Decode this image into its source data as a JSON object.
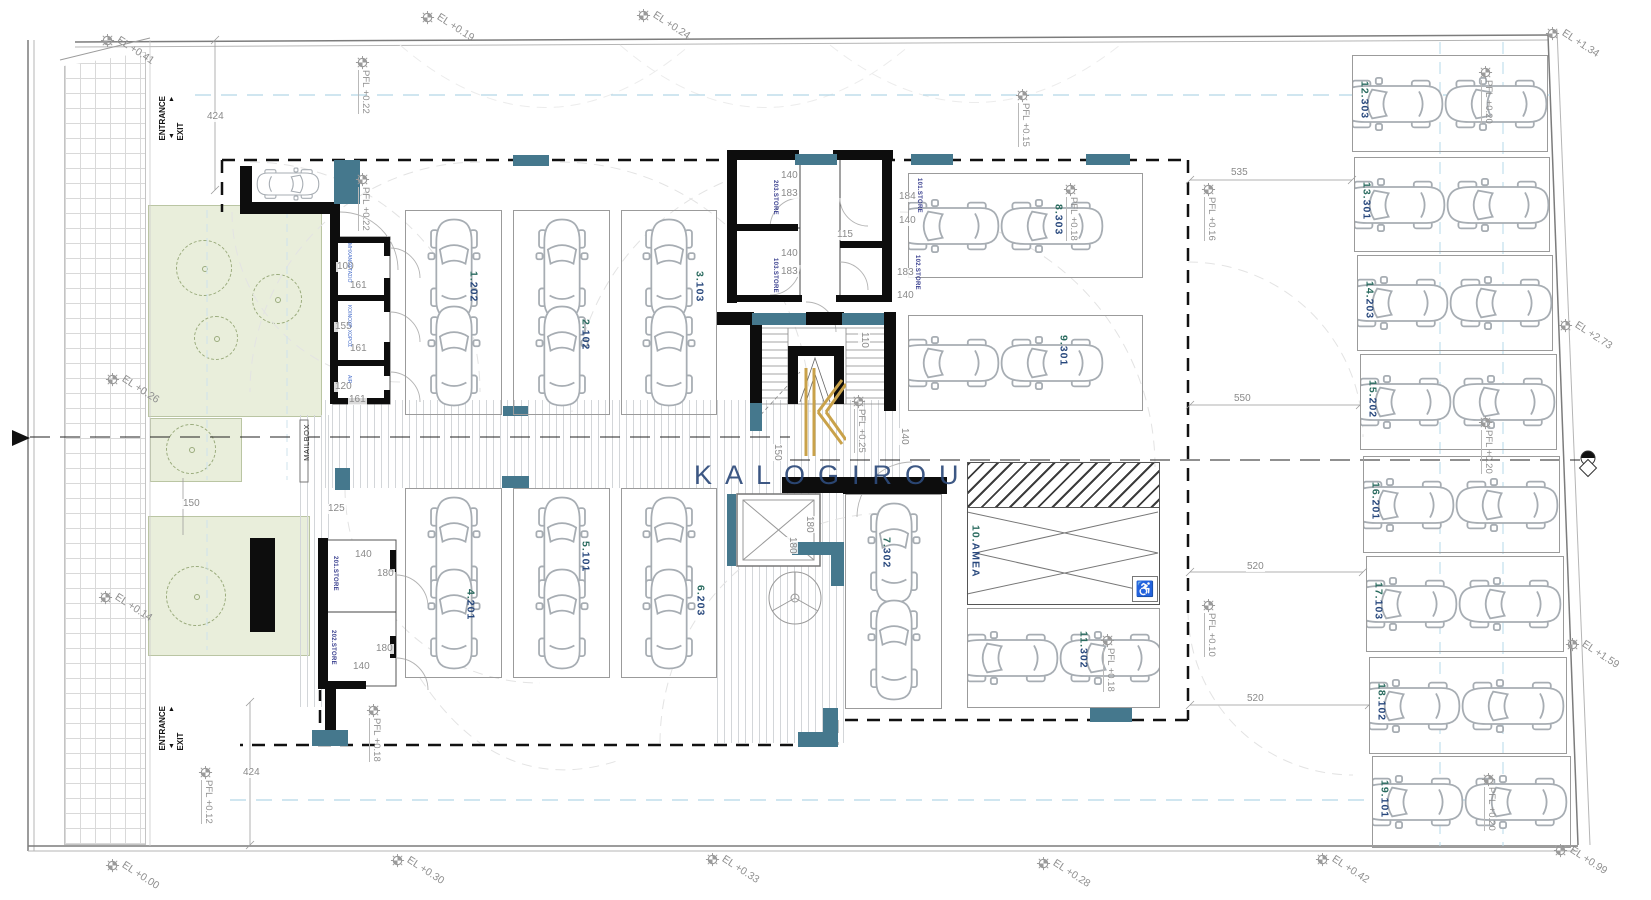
{
  "title": "Parking level floor plan",
  "brand": {
    "logo_text": "KALOGIROU"
  },
  "colors": {
    "teal": "#45788d",
    "wall": "#0d0d0d",
    "parking_num": "#2a6b5f",
    "parking_code": "#27477c",
    "store_text": "#383e8e",
    "room_text": "#4c72cc",
    "dim_text": "#8a8a8a",
    "marker_text": "#8f8f8f",
    "logo_gold": "#c9a24a",
    "logo_navy": "#2d4a7a",
    "green": "#e9eedb",
    "blue_dash": "#b5d8e8"
  },
  "texts": {
    "entrance": "ENTRANCE",
    "exit": "EXIT",
    "arrow_up": "▲",
    "arrow_down": "▼",
    "mailbox": "MAILBOX",
    "wheelchair_icon": "♿"
  },
  "elevation_markers": [
    {
      "label": "EL +0.41",
      "x": 100,
      "y": 33
    },
    {
      "label": "EL +0.19",
      "x": 420,
      "y": 10
    },
    {
      "label": "EL +0.24",
      "x": 636,
      "y": 8
    },
    {
      "label": "EL +1.34",
      "x": 1545,
      "y": 26
    },
    {
      "label": "EL +2.73",
      "x": 1558,
      "y": 318
    },
    {
      "label": "EL +1.59",
      "x": 1565,
      "y": 637
    },
    {
      "label": "EL +0.99",
      "x": 1553,
      "y": 843
    },
    {
      "label": "EL +0.42",
      "x": 1315,
      "y": 852
    },
    {
      "label": "EL +0.28",
      "x": 1036,
      "y": 856
    },
    {
      "label": "EL +0.33",
      "x": 705,
      "y": 852
    },
    {
      "label": "EL +0.30",
      "x": 390,
      "y": 853
    },
    {
      "label": "EL +0.00",
      "x": 105,
      "y": 858
    },
    {
      "label": "EL +0.26",
      "x": 105,
      "y": 372
    },
    {
      "label": "EL +0.14",
      "x": 98,
      "y": 590
    }
  ],
  "pfl_markers": [
    {
      "label": "PFL +0.22",
      "x": 355,
      "y": 55
    },
    {
      "label": "PFL +0.22",
      "x": 355,
      "y": 172
    },
    {
      "label": "PFL +0.15",
      "x": 1015,
      "y": 88
    },
    {
      "label": "PFL +0.18",
      "x": 1063,
      "y": 182
    },
    {
      "label": "PFL +0.16",
      "x": 1201,
      "y": 182
    },
    {
      "label": "PFL +0.25",
      "x": 851,
      "y": 394
    },
    {
      "label": "PFL +0.20",
      "x": 1478,
      "y": 65
    },
    {
      "label": "PFL +0.20",
      "x": 1478,
      "y": 415
    },
    {
      "label": "PFL +0.20",
      "x": 1481,
      "y": 772
    },
    {
      "label": "PFL +0.10",
      "x": 1201,
      "y": 598
    },
    {
      "label": "PFL +0.18",
      "x": 1100,
      "y": 633
    },
    {
      "label": "PFL +0.12",
      "x": 198,
      "y": 765
    },
    {
      "label": "PFL +0.18",
      "x": 366,
      "y": 703
    }
  ],
  "dimensions": [
    {
      "text": "424",
      "x": 206,
      "y": 112
    },
    {
      "text": "424",
      "x": 242,
      "y": 768
    },
    {
      "text": "535",
      "x": 1230,
      "y": 168
    },
    {
      "text": "550",
      "x": 1233,
      "y": 394
    },
    {
      "text": "520",
      "x": 1246,
      "y": 562
    },
    {
      "text": "520",
      "x": 1246,
      "y": 694
    },
    {
      "text": "115",
      "x": 836,
      "y": 230
    },
    {
      "text": "140",
      "x": 780,
      "y": 171
    },
    {
      "text": "183",
      "x": 780,
      "y": 189
    },
    {
      "text": "140",
      "x": 780,
      "y": 249
    },
    {
      "text": "183",
      "x": 780,
      "y": 267
    },
    {
      "text": "184",
      "x": 898,
      "y": 192
    },
    {
      "text": "140",
      "x": 898,
      "y": 216
    },
    {
      "text": "183",
      "x": 896,
      "y": 268
    },
    {
      "text": "140",
      "x": 896,
      "y": 291
    },
    {
      "text": "110",
      "x": 858,
      "y": 332,
      "rot": 90
    },
    {
      "text": "140",
      "x": 898,
      "y": 428,
      "rot": 90
    },
    {
      "text": "150",
      "x": 771,
      "y": 444,
      "rot": 90
    },
    {
      "text": "180",
      "x": 803,
      "y": 516,
      "rot": 90
    },
    {
      "text": "180",
      "x": 786,
      "y": 537,
      "rot": 90
    },
    {
      "text": "100",
      "x": 336,
      "y": 262
    },
    {
      "text": "161",
      "x": 349,
      "y": 281
    },
    {
      "text": "155",
      "x": 334,
      "y": 322
    },
    {
      "text": "161",
      "x": 349,
      "y": 344
    },
    {
      "text": "120",
      "x": 334,
      "y": 382
    },
    {
      "text": "161",
      "x": 348,
      "y": 395
    },
    {
      "text": "125",
      "x": 327,
      "y": 504
    },
    {
      "text": "150",
      "x": 182,
      "y": 499
    },
    {
      "text": "140",
      "x": 354,
      "y": 550
    },
    {
      "text": "180",
      "x": 376,
      "y": 569
    },
    {
      "text": "180",
      "x": 375,
      "y": 644
    },
    {
      "text": "140",
      "x": 352,
      "y": 662
    }
  ],
  "stores": [
    {
      "label": "203.STORE",
      "x": 772,
      "y": 180
    },
    {
      "label": "103.STORE",
      "x": 772,
      "y": 258
    },
    {
      "label": "101.STORE",
      "x": 916,
      "y": 178
    },
    {
      "label": "102.STORE",
      "x": 914,
      "y": 255
    },
    {
      "label": "201.STORE",
      "x": 332,
      "y": 556
    },
    {
      "label": "202.STORE",
      "x": 330,
      "y": 630
    }
  ],
  "utility_rooms": [
    {
      "label": "ΜΗΧΑΝΟΣΤΑΣΙΟ",
      "x": 346,
      "y": 243
    },
    {
      "label": "ΚΟΙΝΟΧΡ. ΧΩΡΟΣ",
      "x": 346,
      "y": 305
    },
    {
      "label": "AIR",
      "x": 346,
      "y": 375
    }
  ],
  "parking": {
    "vertical_stalls": [
      {
        "num": "1.",
        "code": "202",
        "x": 405,
        "y": 210,
        "w": 97,
        "h": 205,
        "lx": 62,
        "ly": 60
      },
      {
        "num": "2.",
        "code": "102",
        "x": 513,
        "y": 210,
        "w": 97,
        "h": 205,
        "lx": 66,
        "ly": 108
      },
      {
        "num": "3.",
        "code": "103",
        "x": 621,
        "y": 210,
        "w": 96,
        "h": 205,
        "lx": 72,
        "ly": 60
      },
      {
        "num": "4.",
        "code": "201",
        "x": 405,
        "y": 488,
        "w": 97,
        "h": 190,
        "lx": 59,
        "ly": 100
      },
      {
        "num": "5.",
        "code": "101",
        "x": 513,
        "y": 488,
        "w": 97,
        "h": 190,
        "lx": 66,
        "ly": 52
      },
      {
        "num": "6.",
        "code": "203",
        "x": 621,
        "y": 488,
        "w": 96,
        "h": 190,
        "lx": 73,
        "ly": 96
      },
      {
        "num": "7.",
        "code": "302",
        "x": 845,
        "y": 494,
        "w": 97,
        "h": 215,
        "lx": 35,
        "ly": 42
      }
    ],
    "horizontal_stalls": [
      {
        "num": "8.",
        "code": "303",
        "x": 908,
        "y": 173,
        "w": 235,
        "h": 105,
        "lx": 144,
        "ly": 30
      },
      {
        "num": "9.",
        "code": "301",
        "x": 908,
        "y": 315,
        "w": 235,
        "h": 96,
        "lx": 149,
        "ly": 19
      },
      {
        "num": "11.",
        "code": "302",
        "x": 967,
        "y": 608,
        "w": 193,
        "h": 100,
        "lx": 110,
        "ly": 22
      },
      {
        "num": "12.",
        "code": "303",
        "x": 1352,
        "y": 55,
        "w": 196,
        "h": 97,
        "lx": 6,
        "ly": 25
      },
      {
        "num": "13.",
        "code": "301",
        "x": 1354,
        "y": 157,
        "w": 196,
        "h": 95,
        "lx": 6,
        "ly": 24
      },
      {
        "num": "14.",
        "code": "203",
        "x": 1357,
        "y": 255,
        "w": 196,
        "h": 96,
        "lx": 6,
        "ly": 25
      },
      {
        "num": "15.",
        "code": "202",
        "x": 1360,
        "y": 354,
        "w": 197,
        "h": 96,
        "lx": 6,
        "ly": 25
      },
      {
        "num": "16.",
        "code": "201",
        "x": 1363,
        "y": 456,
        "w": 197,
        "h": 97,
        "lx": 6,
        "ly": 25
      },
      {
        "num": "17.",
        "code": "103",
        "x": 1366,
        "y": 556,
        "w": 198,
        "h": 96,
        "lx": 6,
        "ly": 25
      },
      {
        "num": "18.",
        "code": "102",
        "x": 1369,
        "y": 657,
        "w": 198,
        "h": 97,
        "lx": 6,
        "ly": 25
      },
      {
        "num": "19.",
        "code": "101",
        "x": 1372,
        "y": 756,
        "w": 199,
        "h": 92,
        "lx": 6,
        "ly": 23
      }
    ],
    "amea": {
      "num": "10.",
      "code": "AMEA",
      "x": 967,
      "y": 462,
      "w": 193,
      "h": 143,
      "lx": 2,
      "ly": 62
    }
  },
  "landscape": {
    "greens": [
      {
        "x": 148,
        "y": 205,
        "w": 174,
        "h": 212
      },
      {
        "x": 150,
        "y": 418,
        "w": 92,
        "h": 64
      },
      {
        "x": 148,
        "y": 516,
        "w": 162,
        "h": 140
      }
    ],
    "trees": [
      {
        "x": 176,
        "y": 240,
        "d": 56
      },
      {
        "x": 252,
        "y": 274,
        "d": 50
      },
      {
        "x": 194,
        "y": 316,
        "d": 44
      },
      {
        "x": 166,
        "y": 424,
        "d": 50
      },
      {
        "x": 166,
        "y": 566,
        "d": 60
      }
    ]
  },
  "stripe_bands": [
    {
      "x": 325,
      "y": 400,
      "w": 575,
      "h": 88
    },
    {
      "x": 717,
      "y": 488,
      "w": 128,
      "h": 255
    },
    {
      "x": 300,
      "y": 415,
      "w": 30,
      "h": 292
    }
  ],
  "walls": [
    {
      "x": 240,
      "y": 166,
      "w": 12,
      "h": 48
    },
    {
      "x": 240,
      "y": 202,
      "w": 94,
      "h": 12
    },
    {
      "x": 330,
      "y": 204,
      "w": 10,
      "h": 36
    },
    {
      "x": 330,
      "y": 237,
      "w": 60,
      "h": 6
    },
    {
      "x": 330,
      "y": 237,
      "w": 8,
      "h": 167
    },
    {
      "x": 330,
      "y": 295,
      "w": 58,
      "h": 6
    },
    {
      "x": 330,
      "y": 360,
      "w": 58,
      "h": 6
    },
    {
      "x": 330,
      "y": 398,
      "w": 58,
      "h": 6
    },
    {
      "x": 384,
      "y": 240,
      "w": 6,
      "h": 16
    },
    {
      "x": 384,
      "y": 278,
      "w": 6,
      "h": 34
    },
    {
      "x": 384,
      "y": 342,
      "w": 6,
      "h": 34
    },
    {
      "x": 384,
      "y": 390,
      "w": 6,
      "h": 14
    },
    {
      "x": 727,
      "y": 150,
      "w": 10,
      "h": 153
    },
    {
      "x": 727,
      "y": 150,
      "w": 72,
      "h": 10
    },
    {
      "x": 833,
      "y": 150,
      "w": 60,
      "h": 10
    },
    {
      "x": 882,
      "y": 153,
      "w": 10,
      "h": 147
    },
    {
      "x": 735,
      "y": 224,
      "w": 63,
      "h": 7
    },
    {
      "x": 840,
      "y": 241,
      "w": 44,
      "h": 7
    },
    {
      "x": 727,
      "y": 295,
      "w": 75,
      "h": 7
    },
    {
      "x": 836,
      "y": 295,
      "w": 56,
      "h": 7
    },
    {
      "x": 716,
      "y": 312,
      "w": 38,
      "h": 13
    },
    {
      "x": 806,
      "y": 312,
      "w": 38,
      "h": 13
    },
    {
      "x": 884,
      "y": 312,
      "w": 12,
      "h": 13
    },
    {
      "x": 750,
      "y": 325,
      "w": 12,
      "h": 78
    },
    {
      "x": 884,
      "y": 325,
      "w": 12,
      "h": 86
    },
    {
      "x": 788,
      "y": 346,
      "w": 10,
      "h": 58
    },
    {
      "x": 788,
      "y": 346,
      "w": 56,
      "h": 10
    },
    {
      "x": 834,
      "y": 346,
      "w": 10,
      "h": 58
    },
    {
      "x": 782,
      "y": 477,
      "w": 62,
      "h": 16
    },
    {
      "x": 843,
      "y": 477,
      "w": 104,
      "h": 17
    },
    {
      "x": 318,
      "y": 538,
      "w": 10,
      "h": 150
    },
    {
      "x": 318,
      "y": 681,
      "w": 48,
      "h": 8
    },
    {
      "x": 390,
      "y": 550,
      "w": 6,
      "h": 22
    },
    {
      "x": 390,
      "y": 636,
      "w": 6,
      "h": 22
    },
    {
      "x": 325,
      "y": 688,
      "w": 11,
      "h": 44
    },
    {
      "x": 250,
      "y": 538,
      "w": 25,
      "h": 94
    }
  ],
  "teal_blocks": [
    {
      "x": 334,
      "y": 160,
      "w": 26,
      "h": 44
    },
    {
      "x": 513,
      "y": 155,
      "w": 36,
      "h": 11
    },
    {
      "x": 795,
      "y": 154,
      "w": 42,
      "h": 11
    },
    {
      "x": 911,
      "y": 154,
      "w": 42,
      "h": 11
    },
    {
      "x": 1086,
      "y": 154,
      "w": 44,
      "h": 11
    },
    {
      "x": 752,
      "y": 313,
      "w": 54,
      "h": 12
    },
    {
      "x": 842,
      "y": 313,
      "w": 42,
      "h": 12
    },
    {
      "x": 750,
      "y": 403,
      "w": 12,
      "h": 28
    },
    {
      "x": 727,
      "y": 494,
      "w": 9,
      "h": 72
    },
    {
      "x": 792,
      "y": 542,
      "w": 52,
      "h": 13
    },
    {
      "x": 831,
      "y": 542,
      "w": 13,
      "h": 44
    },
    {
      "x": 798,
      "y": 732,
      "w": 40,
      "h": 15
    },
    {
      "x": 823,
      "y": 708,
      "w": 15,
      "h": 39
    },
    {
      "x": 1090,
      "y": 708,
      "w": 42,
      "h": 14
    },
    {
      "x": 335,
      "y": 468,
      "w": 15,
      "h": 22
    },
    {
      "x": 502,
      "y": 476,
      "w": 27,
      "h": 12
    },
    {
      "x": 503,
      "y": 406,
      "w": 25,
      "h": 10
    },
    {
      "x": 312,
      "y": 730,
      "w": 36,
      "h": 16
    }
  ]
}
